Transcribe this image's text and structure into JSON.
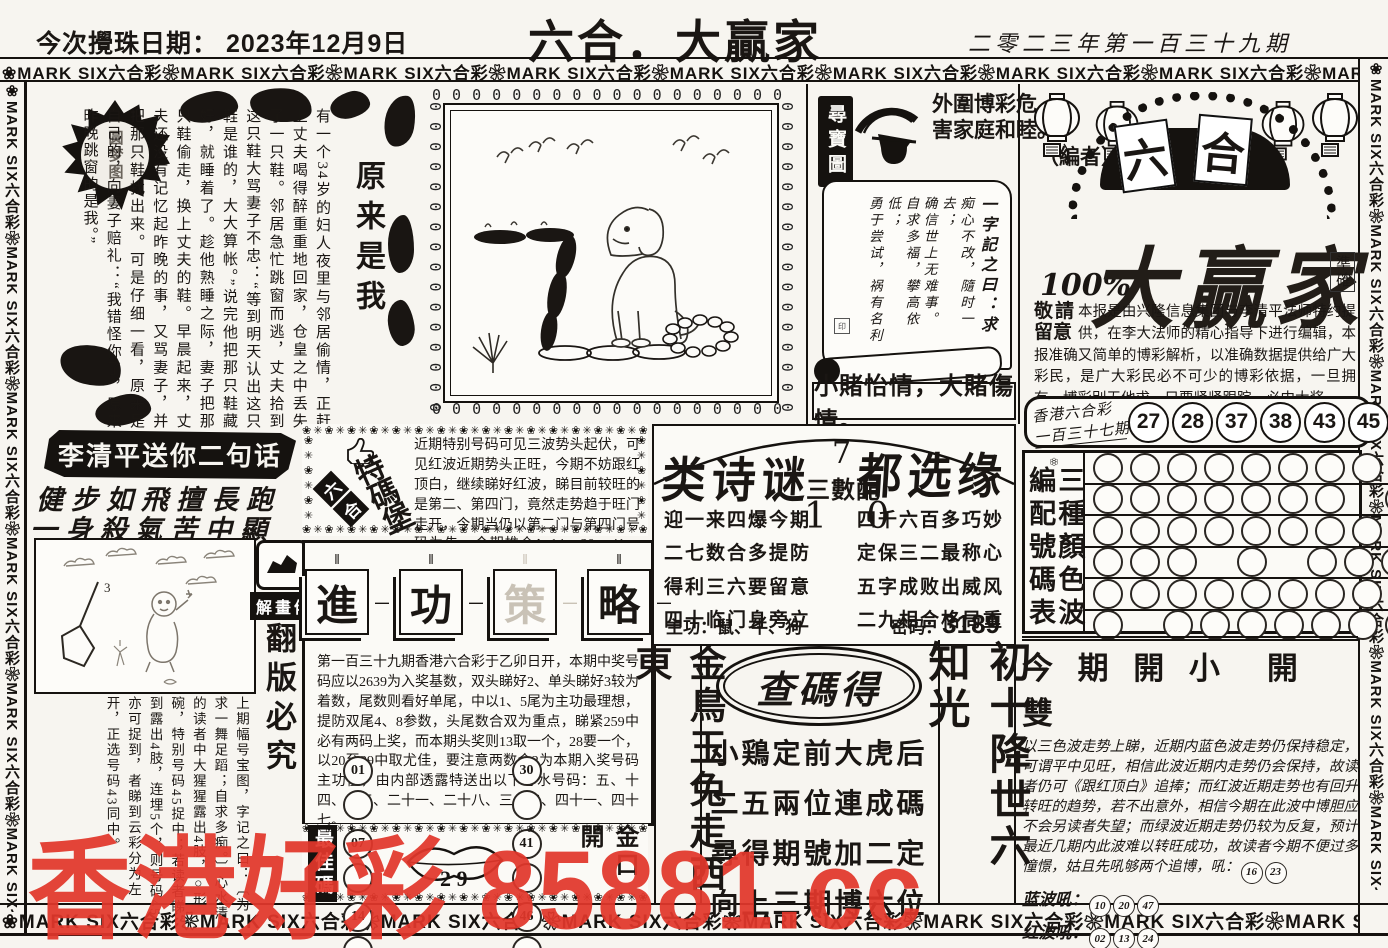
{
  "page": {
    "draw_date_label": "今次攪珠日期：  2023年12月9日",
    "title": "六合．大贏家",
    "issue": "二零二三年第一百三十九期",
    "border_unit": "MARK SIX六合彩",
    "flower": "❀",
    "chain_char": "0"
  },
  "story": {
    "title": "原来是我",
    "badge": "圆梦图",
    "text": "有一个34岁的妇人夜里与邻居偷情，正赶上丈夫喝得醉重重地回家，仓皇之中丢失了一只鞋。邻居急忙跳窗而逃，丈夫拾到这只鞋大骂妻子不忠：“等到明天认出这只鞋是谁的，大大算帐。”说完他把那只鞋藏好，就睡着了。趁他熟睡之际，妻子把那只鞋偷走，换上丈夫的鞋。早晨起来，丈夫还没有记忆起昨晚的事，又骂妻子，并把那只鞋找出来。可是仔细一看，原来是自己的，向妻子赔礼：“我错怪你了，原来昨晚跳窗的是我。”"
  },
  "treasure": {
    "label": "尋寶圖",
    "editor_note_1": "外圍博彩危",
    "editor_note_2": "害家庭和睦。",
    "editor_note_3": "（編者）",
    "scroll_title": "一字記之曰：求",
    "scroll_lines": [
      "痴心不改，隨时一去；",
      "确信世上无难事。",
      "自求多福，攀高依低；",
      "勇于尝试，祸有名利"
    ],
    "seal": "印",
    "caption": "小賭怡情，大賭傷情。"
  },
  "masthead": {
    "arch_char_1": "六",
    "arch_char_2": "合",
    "percent": "100%",
    "brand": "大赢家",
    "seal": "準確",
    "notice_lead": "敬請留意",
    "notice_body": "本报是由兴隆信息集团与李清平法师特约提供，在李大法师的精心指导下进行编辑，本报准确又简单的博彩解析，以准确数据提供给广大彩民，是广大彩民必不可少的博彩依据，一旦拥有，博彩别无他求，只要紧紧跟踪，必中大奖。"
  },
  "last_draw": {
    "label_top": "香港六合彩",
    "label_bottom": "一百三十七期",
    "numbers": [
      "27",
      "28",
      "37",
      "38",
      "43",
      "45"
    ],
    "plus": "+",
    "extra": "40"
  },
  "two_lines": {
    "banner": "李清平送你二句话",
    "line1": "健步如飛擅長跑",
    "line2": "一身殺氣苦中顯"
  },
  "special_fort": {
    "diag_label": "六合彩",
    "main_label": "特碼堡壘",
    "body": "近期特别号码可见三波势头起伏，可见红波近期势头正旺，今期不妨跟红顶白，继续睇好红波，睇目前较旺的是第二、第四门，竟然走势趋于旺门走开，今期当仍以第二门与第四门号码为先，今期推介：14、20、41、42、47。"
  },
  "poem_block": {
    "headline_left": "类诗谜",
    "headline_right": "都选缘",
    "center_top": "7",
    "center_label": "三數配",
    "center_bottom": "1 0",
    "left_lines": [
      "迎一来四爆今期",
      "二七数合多提防",
      "得利三六要留意",
      "四十临门身旁立"
    ],
    "right_lines": [
      "四千六百多巧妙",
      "定保三二最称心",
      "五字成败出威风",
      "二九相合格局重"
    ],
    "zhu_gong": "主功：鼠、牛、狗",
    "password_label": "密码：",
    "password": "3189"
  },
  "color_table": {
    "label_col_1": "三種顏色波",
    "label_col_2": "編配號碼表",
    "rows": [
      [
        1,
        1,
        1,
        1,
        1,
        1,
        1,
        1,
        1
      ],
      [
        1,
        1,
        1,
        1,
        1,
        1,
        1,
        0,
        1
      ],
      [
        1,
        1,
        1,
        1,
        1,
        1,
        1,
        1,
        1
      ],
      [
        1,
        1,
        1,
        0,
        1,
        0,
        1,
        1,
        1
      ],
      [
        1,
        1,
        1,
        1,
        1,
        1,
        1,
        1,
        0
      ],
      [
        1,
        0,
        1,
        1,
        1,
        1,
        1,
        1,
        1
      ]
    ]
  },
  "forecast": {
    "headline": "今 期 開 小　開 雙",
    "body": "以三色波走势上睇，近期内蓝色波走势仍保持稳定，可谓平中见旺，相信此波近期内走势仍会保持，故读者仍可《跟红顶白》追捧；而红波近期走势也有回升转旺的趋势，若不出意外，相信今期在此波中博胆应不会另读者失望；而绿波近期走势仍较为反复，预计最近几期内此波难以转旺成功，故读者今期不便过多憧憬，姑且先吼够两个追博，吼：",
    "first_nums": [
      "16",
      "23"
    ],
    "blue_label": "蓝波吼：",
    "blue_nums": [
      "10",
      "20",
      "47"
    ],
    "red_label": "红波吼：",
    "red_nums": [
      "02",
      "13",
      "24"
    ]
  },
  "decoder": {
    "badge": "解畫佬",
    "warning": "翻版必究",
    "net_number": "3",
    "text": "上期幅号宝图，字记之曰：〔为求一舞足蹈；自求多痴。〕心水清的读者中大猩猩露出4肢，○形碗，特别号码45捉中；若读者睇到露出4肢，连埋5个，则号码45亦可捉到，者睇到云彩分为左开，正选号码43同中。"
  },
  "strategy": {
    "seal_1": "進",
    "seal_2": "功",
    "seal_3": "策",
    "seal_4": "略",
    "body": "第一百三十九期香港六合彩于乙卯日开，本期中奖号码应以2639为入奖基数，双头睇好2、单头睇好3较为着数，尾数则看好单尾，中以1、5尾为主功最理想，提防双尾4、8参数，头尾数合双为重点，睇紧259中必有两码上奖，而本期头奖则13取一个，28要一个，以20至39中取尤佳，要注意两数合2为本期入奖号码主功值，由内部透露特送出以下心水号码：五、十四、十五、二十一、二十八、三十二、四十一、四十七。"
  },
  "best_codes": {
    "left_label": "最佳碼",
    "left_nums": [
      "01",
      "07",
      "14"
    ],
    "lips_nums": "2 9",
    "right_nums": [
      "30",
      "41",
      "46"
    ],
    "right_label": "金口開"
  },
  "bottom_columns": {
    "gold_bird": "金鳥玉兔走西東",
    "oval": "查碼得",
    "check_lines": [
      "小鶏定前大虎后",
      "二五兩位連成碼",
      "尋得期號加二定",
      "向上三期博六位"
    ],
    "chushi": "初十降世六知光"
  },
  "watermark": {
    "text": "香港好彩 85881.cc",
    "color": "#e2372b"
  }
}
